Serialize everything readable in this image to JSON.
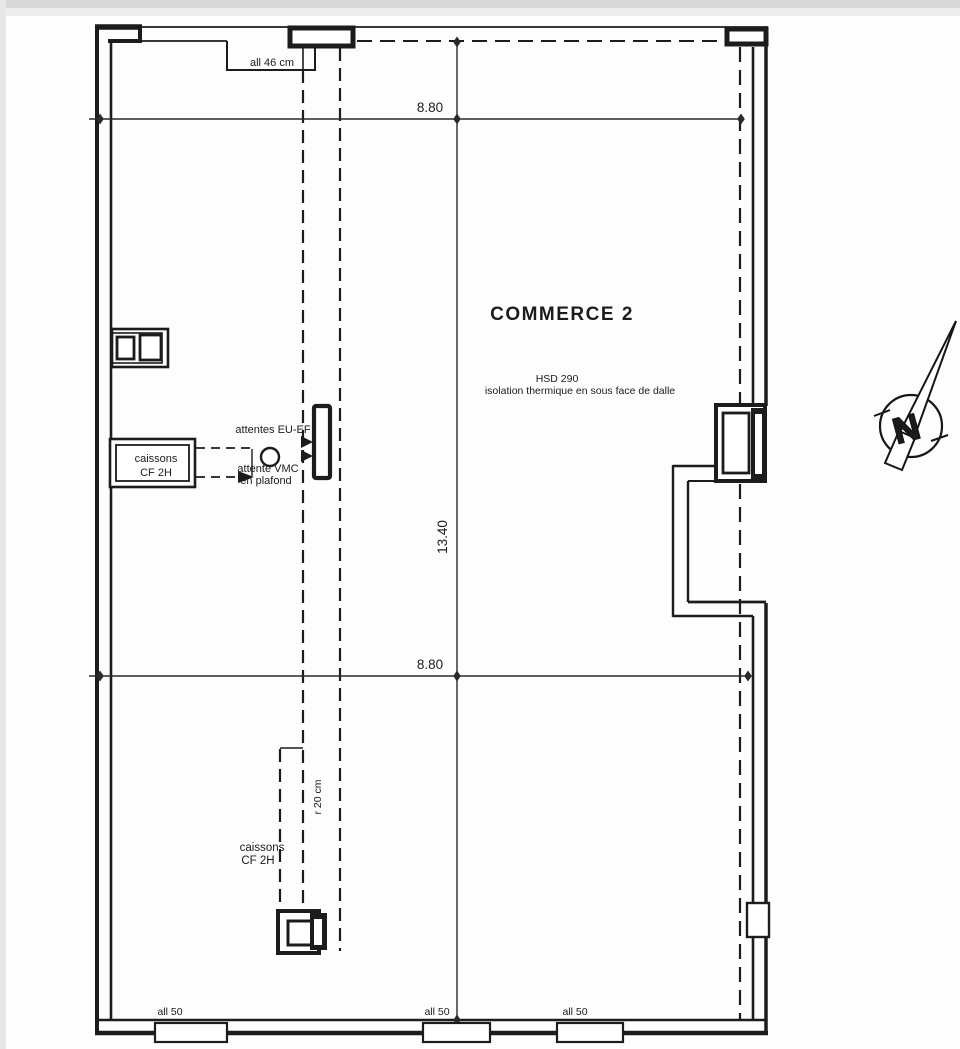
{
  "plan": {
    "room": {
      "name": "COMMERCE 2",
      "note1": "HSD 290",
      "note2": "isolation thermique en sous face de dalle"
    },
    "dims": {
      "width_top": "8.80",
      "width_mid": "8.80",
      "height": "13.40"
    },
    "sills": {
      "top": "all 46 cm",
      "bottom1": "all 50",
      "bottom2": "all 50",
      "bottom3": "all 50"
    },
    "caisson_upper": {
      "line1": "caissons",
      "line2": "CF 2H"
    },
    "caisson_lower": {
      "line1": "caissons",
      "line2": "CF 2H"
    },
    "annotations": {
      "attentes": "attentes EU-EF",
      "vmc1": "attente VMC",
      "vmc2": "en plafond",
      "duct": "r 20 cm"
    },
    "north": {
      "letter": "N"
    },
    "colors": {
      "ink": "#1c1c1c"
    }
  }
}
